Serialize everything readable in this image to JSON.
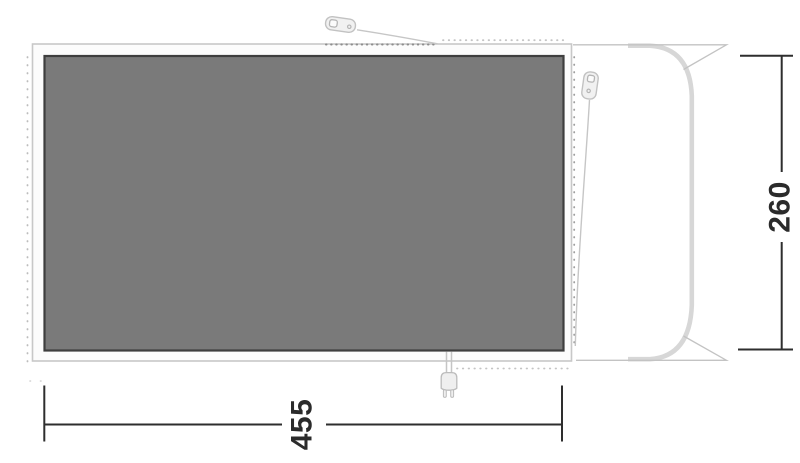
{
  "diagram": {
    "dimension_labels": {
      "width": "455",
      "depth": "260"
    },
    "colors": {
      "background": "#ffffff",
      "floor_fill": "#7a7a7a",
      "floor_border": "#3e3e3e",
      "outline_light": "#c8c8c8",
      "dotted_dark": "#8d8d8d",
      "dotted_light": "#c4c4c4",
      "pole_gray": "#d7d7d7",
      "guy_line_gray": "#c6c6c6",
      "dimension_dark": "#2e2e2e",
      "icon_fill": "#f1f1f1",
      "icon_stroke": "#c0c0c0"
    },
    "icons": {
      "top_peg": "tent-peg-icon",
      "side_peg": "tent-peg-icon",
      "plug": "power-plug-icon"
    }
  }
}
